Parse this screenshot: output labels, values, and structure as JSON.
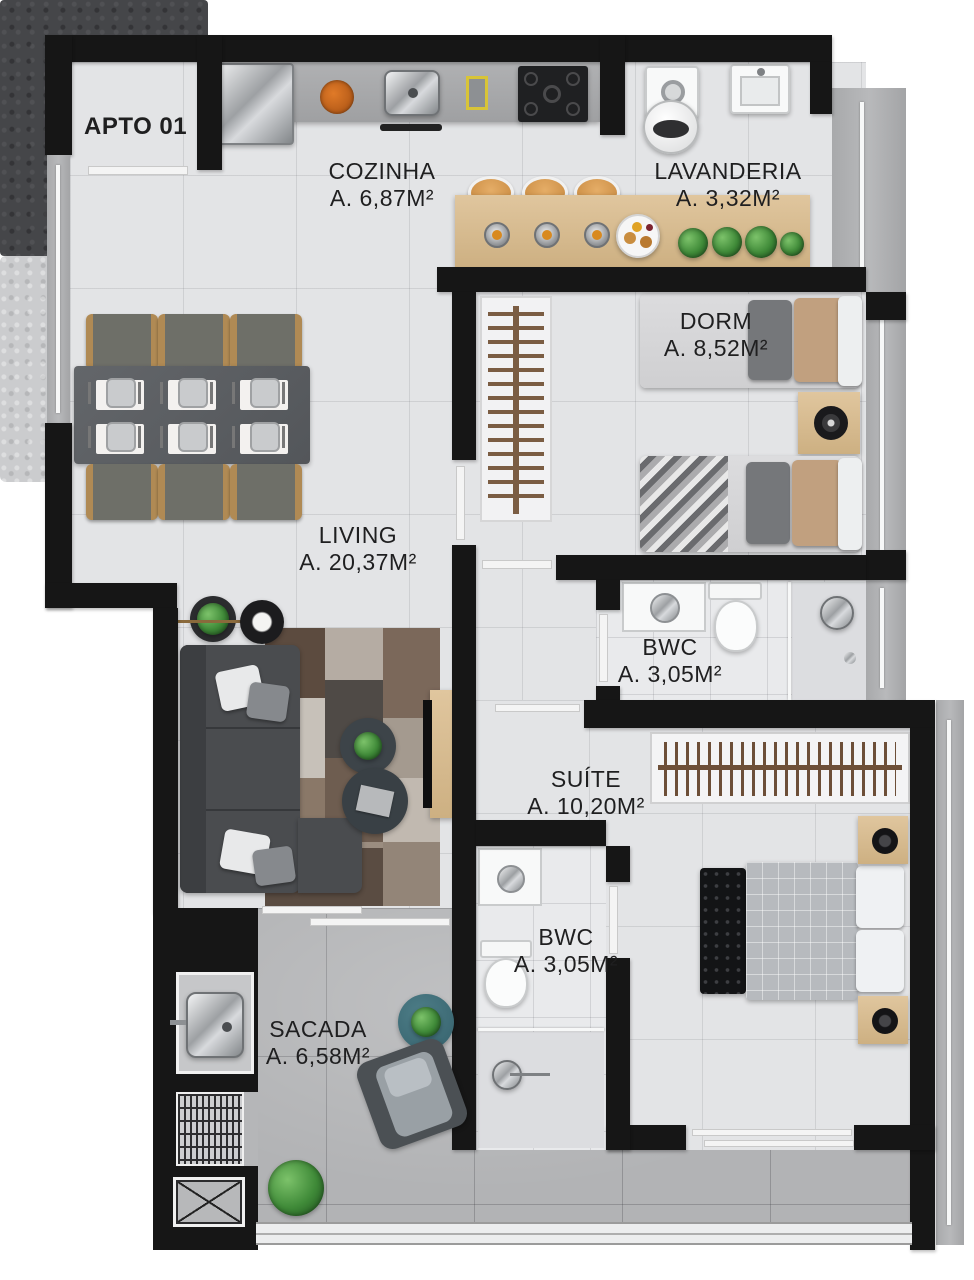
{
  "apartment": {
    "title": "APTO 01"
  },
  "rooms": [
    {
      "name": "COZINHA",
      "area": "A. 6,87M²"
    },
    {
      "name": "LAVANDERIA",
      "area": "A. 3,32M²"
    },
    {
      "name": "DORM",
      "area": "A. 8,52M²"
    },
    {
      "name": "LIVING",
      "area": "A. 20,37M²"
    },
    {
      "name": "BWC",
      "area": "A. 3,05M²"
    },
    {
      "name": "SUÍTE",
      "area": "A. 10,20M²"
    },
    {
      "name": "BWC",
      "area": "A. 3,05M²"
    },
    {
      "name": "SACADA",
      "area": "A. 6,58M²"
    }
  ],
  "colors": {
    "wall": "#161616",
    "floor_tile": "#e3e4e6",
    "balcony_concrete": "#b2b3b5",
    "wood": "#d9bf97",
    "plant_green": "#3f8a38",
    "label_text": "#1f1f20"
  }
}
